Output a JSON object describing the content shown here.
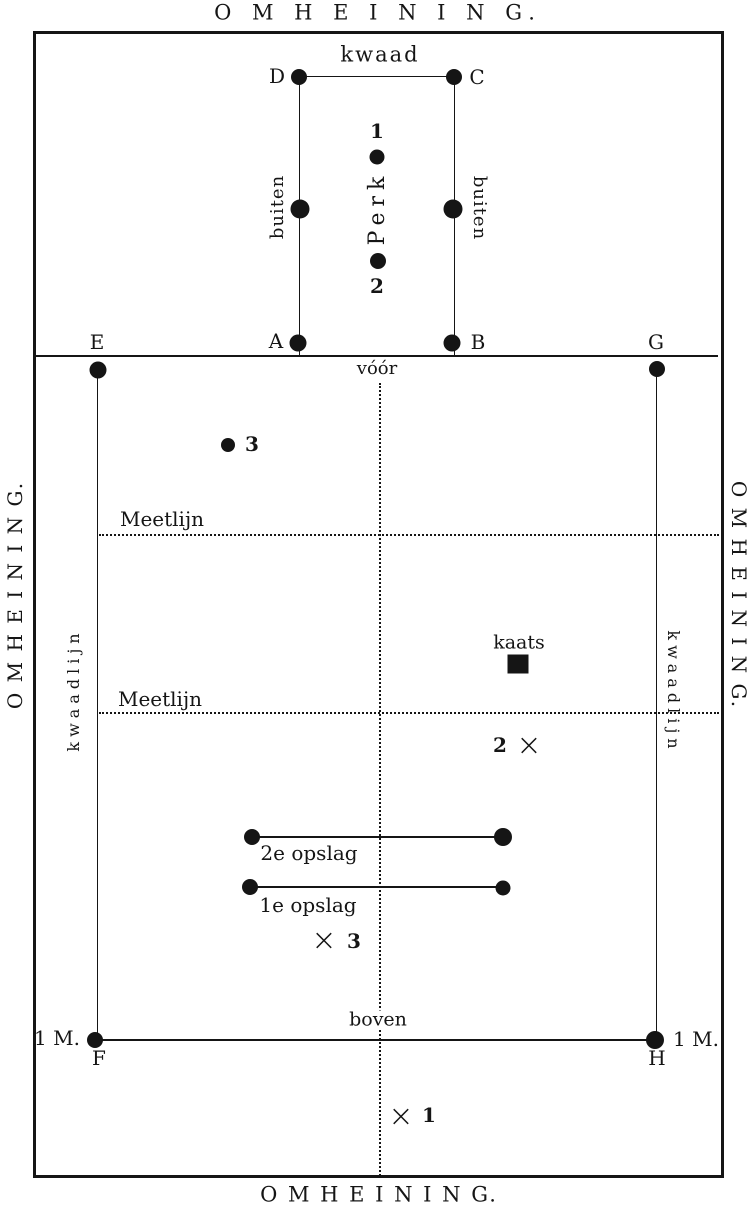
{
  "colors": {
    "ink": "#151515",
    "paper": "#ffffff"
  },
  "fence": {
    "top": "O M H E I N I N G.",
    "bottom": "O M H E I N I N G.",
    "left": "O M H E I N I N G.",
    "right": "O M H E I N I N G."
  },
  "perk": {
    "kwaad_label": "kwaad",
    "name": "Perk",
    "buiten_left": "buiten",
    "buiten_right": "buiten",
    "corner_d": "D",
    "corner_c": "C",
    "corner_a": "A",
    "corner_b": "B",
    "player_1": "1",
    "player_2": "2"
  },
  "field": {
    "corner_e": "E",
    "corner_g": "G",
    "corner_f": "F",
    "corner_h": "H",
    "voor_label": "vóór",
    "boven_label": "boven",
    "meetlijn_1": "Meetlijn",
    "meetlijn_2": "Meetlijn",
    "kwaadlijn_left": "kwaadlijn",
    "kwaadlijn_right": "kwaadlijn",
    "kaats_label": "kaats",
    "opslag_2": "2e opslag",
    "opslag_1": "1e opslag",
    "margin_left": "1 M.",
    "margin_right": "1 M.",
    "receiver_3": "3",
    "cross_glyph": "×",
    "cross_1": "1",
    "cross_2": "2",
    "cross_3": "3"
  }
}
